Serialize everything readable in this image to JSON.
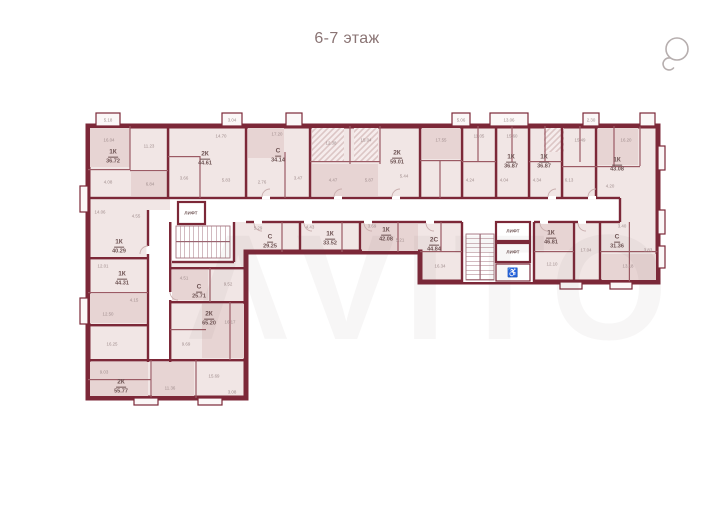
{
  "header": {
    "title": "6-7 этаж"
  },
  "watermark": {
    "text": "ΛVITO"
  },
  "icons": {
    "rotate": "rotate-icon",
    "accessible": "♿"
  },
  "colors": {
    "wall": "#7c2838",
    "room": "#f1e6e5",
    "room_dark": "#e7d4d3",
    "label": "#6d5252",
    "dims": "#a18e8e",
    "title": "#8a7474"
  },
  "plan": {
    "lift_label": "ЛИФТ",
    "units": [
      {
        "type": "1К",
        "area": "36.72",
        "x": 113,
        "y": 153
      },
      {
        "type": "2К",
        "area": "44.61",
        "x": 205,
        "y": 155
      },
      {
        "type": "С",
        "area": "34.14",
        "x": 278,
        "y": 152
      },
      {
        "type": "2К",
        "area": "59.01",
        "x": 397,
        "y": 154
      },
      {
        "type": "1К",
        "area": "36.87",
        "x": 511,
        "y": 158
      },
      {
        "type": "1К",
        "area": "36.87",
        "x": 544,
        "y": 158
      },
      {
        "type": "1К",
        "area": "43.08",
        "x": 617,
        "y": 161
      },
      {
        "type": "С",
        "area": "29.25",
        "x": 270,
        "y": 238
      },
      {
        "type": "1К",
        "area": "33.52",
        "x": 330,
        "y": 235
      },
      {
        "type": "1К",
        "area": "42.08",
        "x": 386,
        "y": 231
      },
      {
        "type": "2С",
        "area": "44.84",
        "x": 434,
        "y": 241
      },
      {
        "type": "1К",
        "area": "46.81",
        "x": 551,
        "y": 234
      },
      {
        "type": "С",
        "area": "31.36",
        "x": 617,
        "y": 238
      },
      {
        "type": "1К",
        "area": "40.29",
        "x": 119,
        "y": 243
      },
      {
        "type": "1К",
        "area": "44.31",
        "x": 122,
        "y": 275
      },
      {
        "type": "С",
        "area": "25.71",
        "x": 199,
        "y": 288
      },
      {
        "type": "2К",
        "area": "65.20",
        "x": 209,
        "y": 315
      },
      {
        "type": "2К",
        "area": "55.77",
        "x": 121,
        "y": 383
      }
    ],
    "lifts": [
      {
        "x": 191,
        "y": 213
      },
      {
        "x": 513,
        "y": 231
      },
      {
        "x": 513,
        "y": 252
      }
    ],
    "dims": [
      {
        "v": "5.18",
        "x": 108,
        "y": 120
      },
      {
        "v": "3.04",
        "x": 232,
        "y": 120
      },
      {
        "v": "5.06",
        "x": 461,
        "y": 120
      },
      {
        "v": "13.06",
        "x": 509,
        "y": 120
      },
      {
        "v": "2.30",
        "x": 591,
        "y": 120
      },
      {
        "v": "16.04",
        "x": 109,
        "y": 140
      },
      {
        "v": "11.23",
        "x": 149,
        "y": 146
      },
      {
        "v": "14.70",
        "x": 221,
        "y": 136
      },
      {
        "v": "17.20",
        "x": 277,
        "y": 134
      },
      {
        "v": "12.38",
        "x": 331,
        "y": 143
      },
      {
        "v": "15.04",
        "x": 366,
        "y": 140
      },
      {
        "v": "17.55",
        "x": 441,
        "y": 140
      },
      {
        "v": "11.05",
        "x": 479,
        "y": 136
      },
      {
        "v": "15.60",
        "x": 512,
        "y": 136
      },
      {
        "v": "15.49",
        "x": 580,
        "y": 140
      },
      {
        "v": "16.20",
        "x": 626,
        "y": 140
      },
      {
        "v": "4.08",
        "x": 108,
        "y": 182
      },
      {
        "v": "6.84",
        "x": 150,
        "y": 184
      },
      {
        "v": "3.66",
        "x": 184,
        "y": 178
      },
      {
        "v": "5.83",
        "x": 226,
        "y": 180
      },
      {
        "v": "2.76",
        "x": 262,
        "y": 182
      },
      {
        "v": "3.47",
        "x": 298,
        "y": 178
      },
      {
        "v": "4.47",
        "x": 333,
        "y": 180
      },
      {
        "v": "5.87",
        "x": 369,
        "y": 180
      },
      {
        "v": "5.44",
        "x": 404,
        "y": 176
      },
      {
        "v": "4.24",
        "x": 470,
        "y": 180
      },
      {
        "v": "4.04",
        "x": 504,
        "y": 180
      },
      {
        "v": "4.34",
        "x": 537,
        "y": 180
      },
      {
        "v": "6.13",
        "x": 569,
        "y": 180
      },
      {
        "v": "4.20",
        "x": 610,
        "y": 186
      },
      {
        "v": "5.29",
        "x": 258,
        "y": 228
      },
      {
        "v": "4.43",
        "x": 310,
        "y": 227
      },
      {
        "v": "3.69",
        "x": 372,
        "y": 226
      },
      {
        "v": "5.21",
        "x": 400,
        "y": 240
      },
      {
        "v": "16.34",
        "x": 440,
        "y": 266
      },
      {
        "v": "12.10",
        "x": 552,
        "y": 264
      },
      {
        "v": "17.04",
        "x": 586,
        "y": 250
      },
      {
        "v": "3.40",
        "x": 622,
        "y": 226
      },
      {
        "v": "13.18",
        "x": 628,
        "y": 266
      },
      {
        "v": "3.83",
        "x": 648,
        "y": 250
      },
      {
        "v": "14.06",
        "x": 100,
        "y": 212
      },
      {
        "v": "4.55",
        "x": 136,
        "y": 216
      },
      {
        "v": "12.01",
        "x": 103,
        "y": 266
      },
      {
        "v": "4.15",
        "x": 134,
        "y": 300
      },
      {
        "v": "12.50",
        "x": 108,
        "y": 314
      },
      {
        "v": "4.51",
        "x": 184,
        "y": 278
      },
      {
        "v": "9.52",
        "x": 228,
        "y": 284
      },
      {
        "v": "16.17",
        "x": 230,
        "y": 322
      },
      {
        "v": "9.69",
        "x": 186,
        "y": 344
      },
      {
        "v": "16.25",
        "x": 112,
        "y": 344
      },
      {
        "v": "15.69",
        "x": 214,
        "y": 376
      },
      {
        "v": "9.03",
        "x": 104,
        "y": 372
      },
      {
        "v": "11.36",
        "x": 170,
        "y": 388
      },
      {
        "v": "3.08",
        "x": 232,
        "y": 392
      }
    ]
  }
}
